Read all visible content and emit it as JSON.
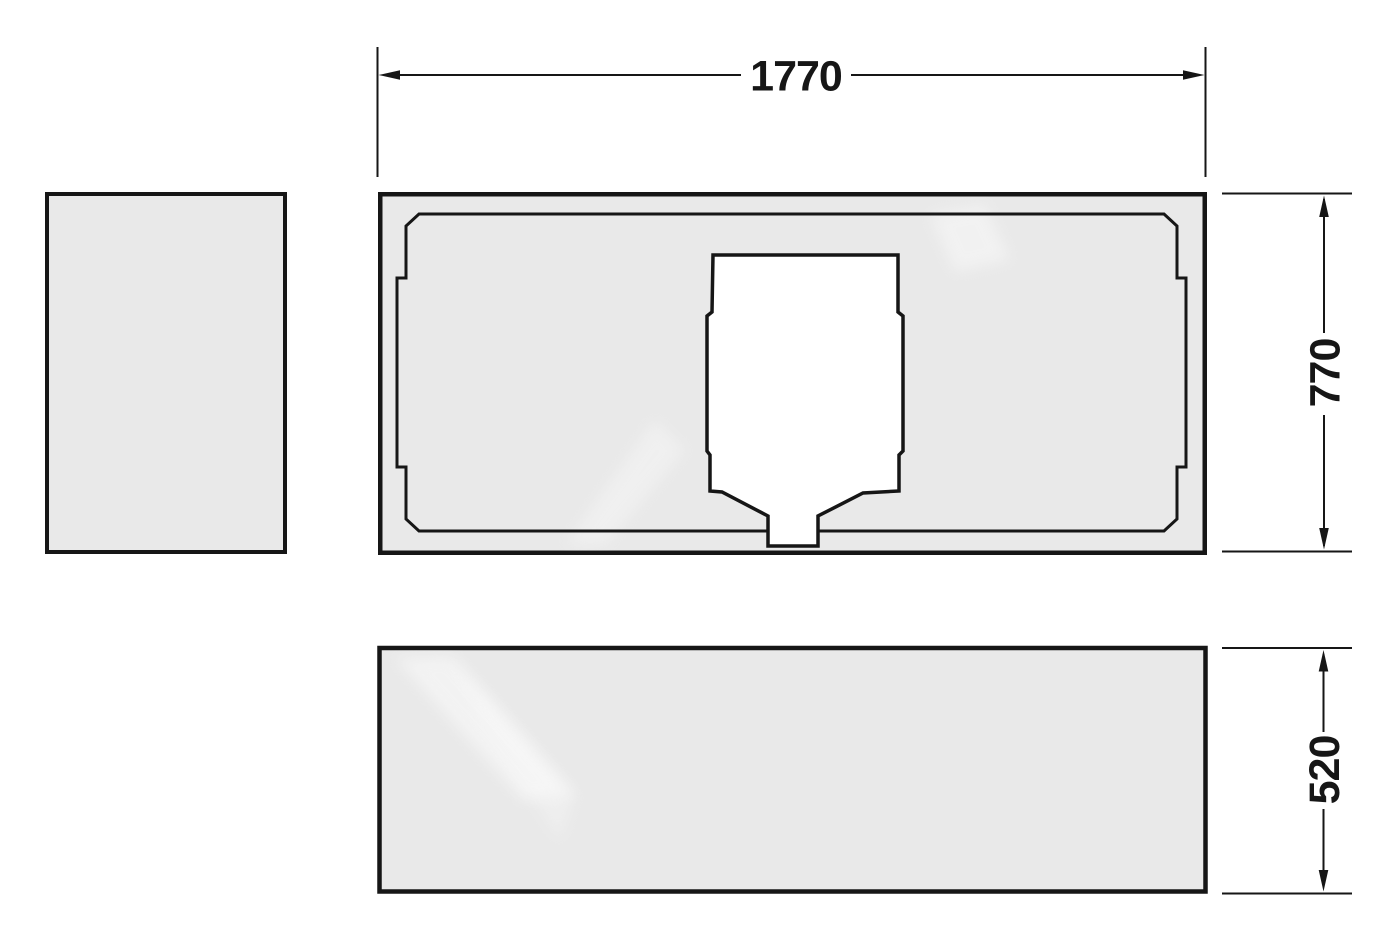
{
  "dimensions": {
    "width": {
      "label": "1770"
    },
    "depth": {
      "label": "770"
    },
    "height": {
      "label": "520"
    }
  },
  "colors": {
    "background": "#ffffff",
    "panel_fill": "#e9e9e9",
    "cutout_fill": "#ffffff",
    "line": "#161616"
  }
}
